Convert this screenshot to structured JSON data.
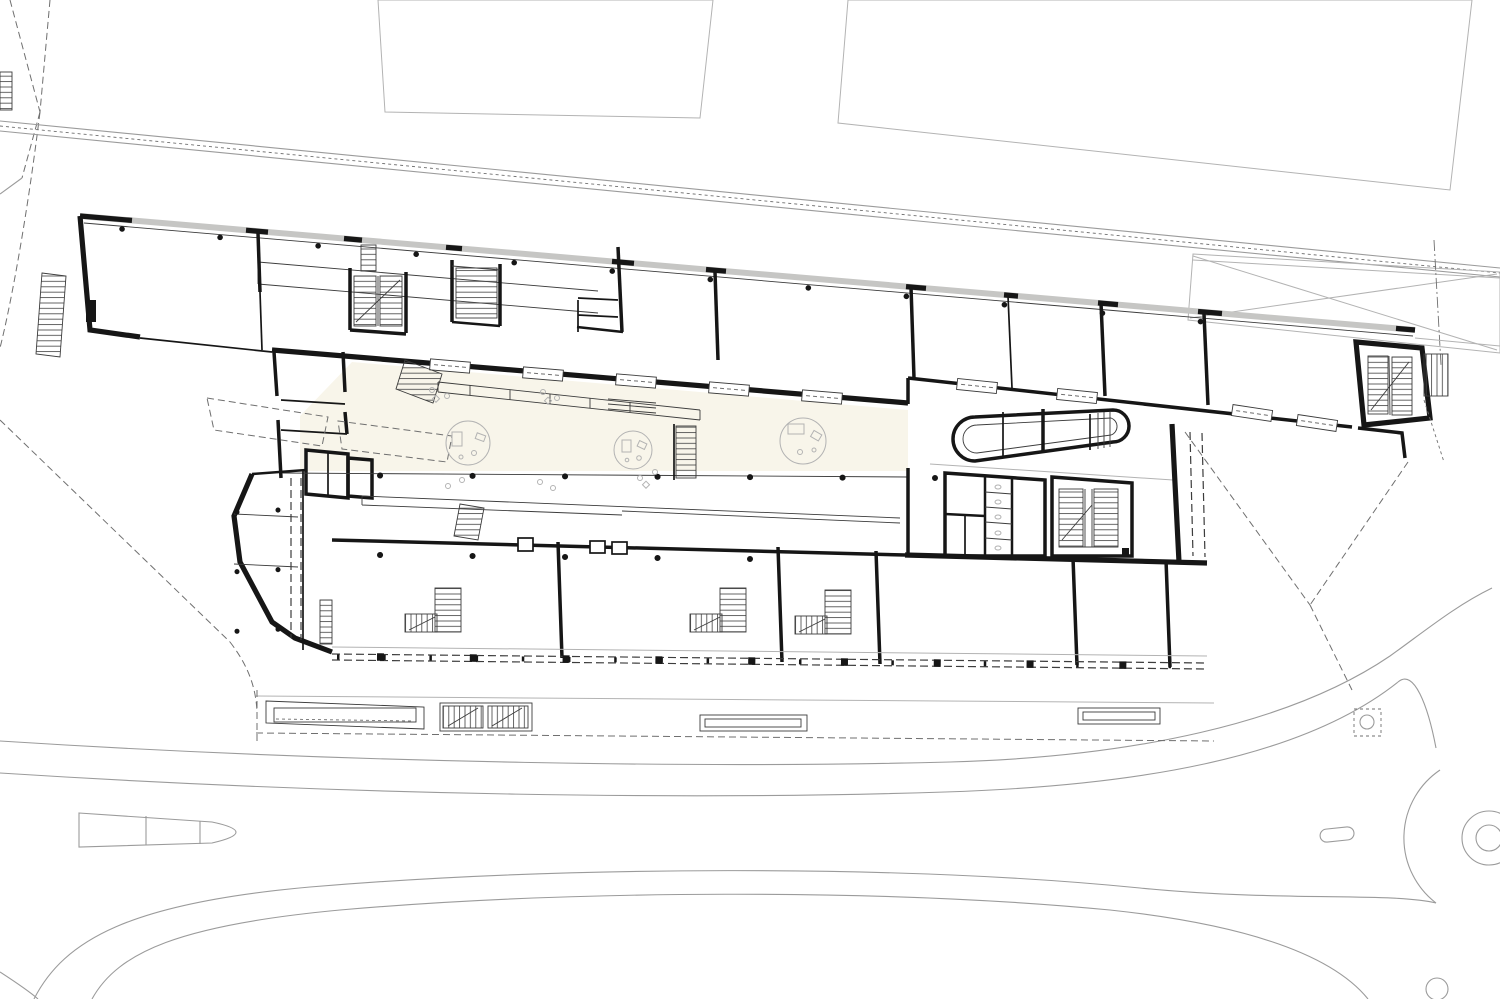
{
  "document": {
    "kind": "architectural-ground-floor-site-plan",
    "visible_text": []
  },
  "colors": {
    "paper": "#ffffff",
    "ink": "#161616",
    "ink-soft": "#3c3c3c",
    "gray-line": "#9b9b9b",
    "hairline": "#b3b3b3",
    "dash": "#6f6f6f",
    "band": "#c6c6c4",
    "neighbor": "#edebe6",
    "atrium": "#f8f5ea",
    "tread": "#4a4a4a"
  },
  "inventory": {
    "neighbor_buildings": 2,
    "round_lounge_rugs": 3,
    "classroom_stairs": 3,
    "stair_cores": 5,
    "exterior_stairs": 3,
    "window_strips": 9,
    "wc_block": 1,
    "pill_shaped_core": 1,
    "vehicle_ramp": 1,
    "roundabout": 1,
    "traffic_islands": 2,
    "walkway_planters": 3,
    "tree_pit": 1
  }
}
